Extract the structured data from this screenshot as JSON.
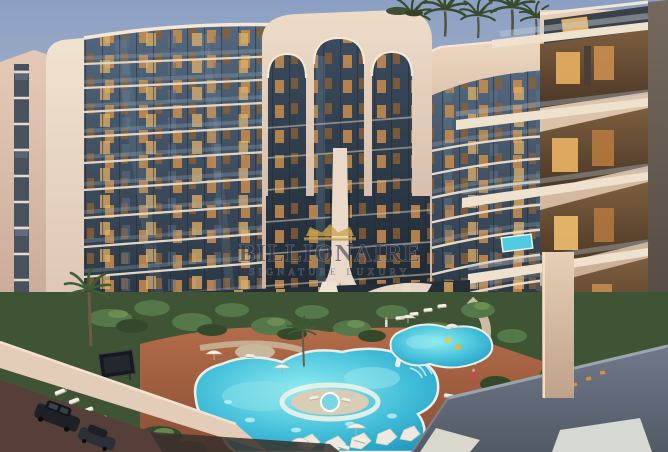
{
  "image": {
    "kind": "architectural-rendering",
    "subject": "Curved luxury residential towers with landscaped lagoon-pool courtyard at dusk"
  },
  "watermark": {
    "brand": "BILLIONAIRE",
    "tagline": "SIGNATURE LUXURY",
    "crown_color": "#c9a24a"
  },
  "palette": {
    "sky_top": "#8aa0c4",
    "sky_horizon": "#c9b9b5",
    "facade_cream": "#ecdac8",
    "facade_pink": "#d9bcab",
    "glass_blue": "#3c4d60",
    "window_glow": "#e0ac60",
    "pool_turquoise": "#3ec2da",
    "deck_terracotta": "#a96245",
    "garden_green": "#46603a",
    "terrace_gray": "#626b79",
    "street_brown": "#553f38",
    "car_black": "#1d2125"
  }
}
